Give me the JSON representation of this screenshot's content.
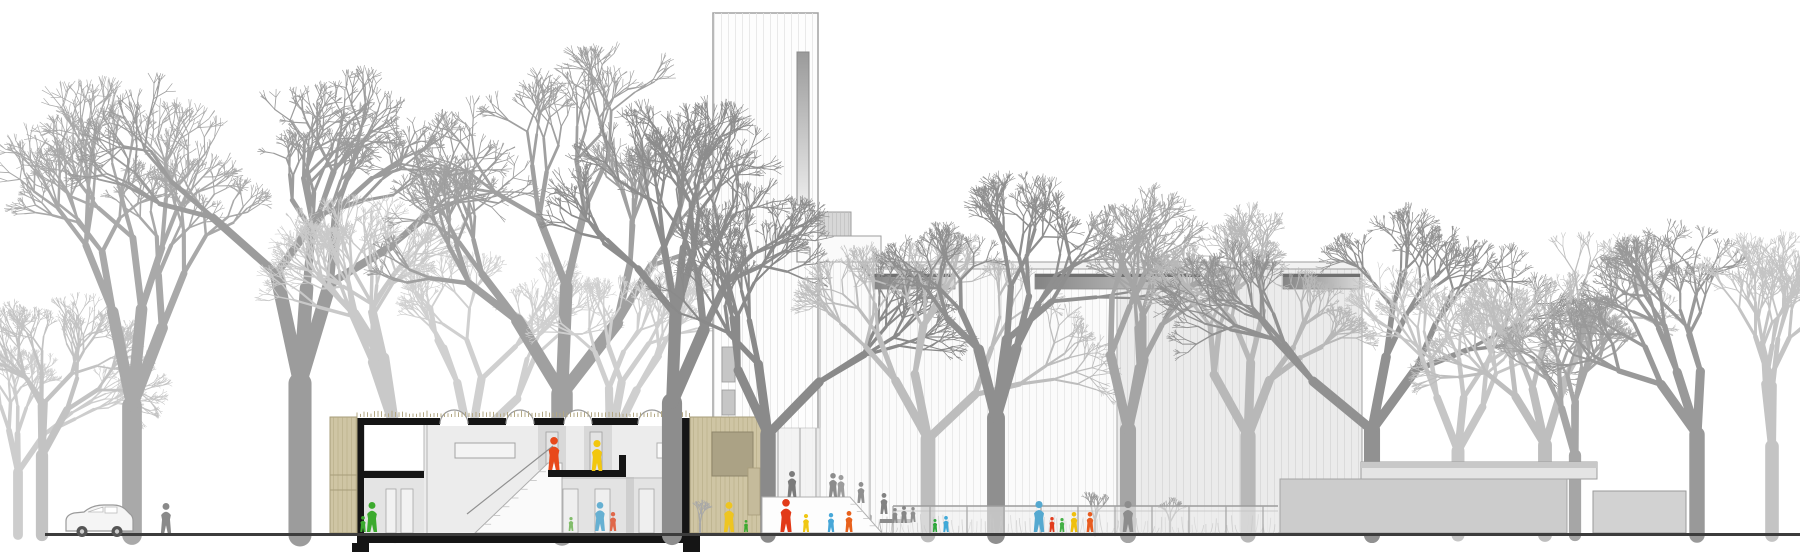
{
  "meta": {
    "drawing_type": "architectural-section-elevation",
    "subject": "church-ensemble-with-sectioned-community-building"
  },
  "scene": {
    "width": 1800,
    "height": 557,
    "background": "#ffffff",
    "ground": {
      "y": 533,
      "x_start": 45,
      "x_end": 1800,
      "color": "#3c3c3c",
      "thickness": 3
    }
  },
  "palette": {
    "section_black": "#151515",
    "interior_gray": "#ececec",
    "interior_light": "#e4e4e4",
    "wood": "#cfc5a4",
    "wood_stripe": "#b4a984",
    "wood_inset": "#aba285",
    "tower_fill": "#fdfdfd",
    "tower_stripe": "#e4e4e4",
    "tower_outline": "#a2a2a2",
    "nave_left_fill": "#fbfbfb",
    "nave_left_stripe": "#e7e7e7",
    "nave_right_fill": "#ebebeb",
    "nave_right_stripe": "#d9d9d9",
    "annex_roof_band": "#c8c8c8",
    "annex_roof_fill": "#e4e4e4",
    "annex_wall": "#cccccc",
    "annex_block": "#d2d2d2",
    "outline_gray": "#9e9e9e",
    "glass": "#f2f2f2",
    "fence_post": "#a5a5a5",
    "shrub": "#a3a3a3",
    "figure_orange": "#e8491b",
    "figure_red": "#e23a18",
    "figure_yellow": "#f2c70e",
    "figure_green": "#3caa2e",
    "figure_teal": "#5badd2",
    "figure_salmon": "#e0684a",
    "figure_gray": "#8a8a8a",
    "roof_fringe": "#b3a884",
    "car_body": "#f5f5f5",
    "car_outline": "#9a9a9a",
    "wheel": "#555555"
  },
  "trees": {
    "background": [
      {
        "x": 18,
        "height": 210,
        "color": "#cdcdcd",
        "seed": 11,
        "spread": 1.0
      },
      {
        "x": 42,
        "height": 265,
        "color": "#c3c3c3",
        "seed": 12,
        "spread": 1.05
      },
      {
        "x": 132,
        "height": 430,
        "color": "#a9a9a9",
        "seed": 13,
        "spread": 1.1
      },
      {
        "x": 300,
        "height": 505,
        "color": "#9c9c9c",
        "seed": 14,
        "spread": 1.3
      },
      {
        "x": 395,
        "height": 355,
        "color": "#c9c9c9",
        "seed": 15,
        "spread": 1.1
      },
      {
        "x": 470,
        "height": 305,
        "color": "#d0d0d0",
        "seed": 16,
        "spread": 1.0
      },
      {
        "x": 562,
        "height": 470,
        "color": "#a0a0a0",
        "seed": 17,
        "spread": 1.1
      },
      {
        "x": 610,
        "height": 300,
        "color": "#cfcfcf",
        "seed": 19,
        "spread": 1.0
      }
    ],
    "midground": [
      {
        "x": 672,
        "height": 440,
        "color": "#8d8d8d",
        "seed": 18,
        "spread": 1.1
      },
      {
        "x": 768,
        "height": 335,
        "color": "#8a8a8a",
        "seed": 21,
        "spread": 1.05
      },
      {
        "x": 928,
        "height": 320,
        "color": "#bdbdbd",
        "seed": 22,
        "spread": 1.1
      },
      {
        "x": 996,
        "height": 390,
        "color": "#8f8f8f",
        "seed": 23,
        "spread": 1.15
      },
      {
        "x": 1128,
        "height": 350,
        "color": "#a5a5a5",
        "seed": 24,
        "spread": 1.1
      },
      {
        "x": 1248,
        "height": 330,
        "color": "#b8b8b8",
        "seed": 25,
        "spread": 1.05
      },
      {
        "x": 1372,
        "height": 350,
        "color": "#919191",
        "seed": 26,
        "spread": 1.1
      },
      {
        "x": 1458,
        "height": 280,
        "color": "#c6c6c6",
        "seed": 27,
        "spread": 1.0
      },
      {
        "x": 1545,
        "height": 300,
        "color": "#bebebe",
        "seed": 28,
        "spread": 1.1
      },
      {
        "x": 1575,
        "height": 265,
        "color": "#a6a6a6",
        "seed": 29,
        "spread": 1.0
      },
      {
        "x": 1697,
        "height": 335,
        "color": "#999999",
        "seed": 30,
        "spread": 1.15
      },
      {
        "x": 1772,
        "height": 295,
        "color": "#c4c4c4",
        "seed": 31,
        "spread": 1.0
      }
    ],
    "saplings": [
      {
        "x": 1095,
        "height": 48,
        "color": "#9a9a9a",
        "seed": 41,
        "spread": 1.0
      },
      {
        "x": 1170,
        "height": 42,
        "color": "#a2a2a2",
        "seed": 42,
        "spread": 1.0
      },
      {
        "x": 700,
        "height": 38,
        "color": "#a8a8a8",
        "seed": 43,
        "spread": 1.0
      }
    ]
  },
  "section_building": {
    "wood_bay_left": {
      "x": 330,
      "y": 417,
      "w": 27,
      "h": 116,
      "panel_lines_y": [
        475,
        490
      ]
    },
    "left_wall": {
      "x": 357,
      "y": 418,
      "w": 7,
      "h": 115
    },
    "right_wall": {
      "x": 681,
      "y": 418,
      "w": 11,
      "h": 115
    },
    "roof_band": {
      "x": 357,
      "y": 418,
      "w": 335,
      "h": 7
    },
    "roof_fringe": {
      "x1": 357,
      "x2": 692,
      "y": 417
    },
    "arch_skylights": {
      "centers_x": [
        454,
        520,
        578,
        652
      ],
      "half_width": 14,
      "base_y": 424
    },
    "floor_slab": {
      "x": 357,
      "y": 533,
      "w": 343,
      "h": 10
    },
    "footings": [
      {
        "x": 352,
        "y": 543,
        "w": 17,
        "h": 9
      },
      {
        "x": 683,
        "y": 543,
        "w": 17,
        "h": 9
      }
    ],
    "interior": {
      "x": 364,
      "y": 424,
      "w": 317,
      "h": 109
    },
    "upper_left_room": {
      "x": 364,
      "y": 424,
      "w": 60,
      "h": 47
    },
    "interior_slab": {
      "x": 357,
      "y": 471,
      "w": 67,
      "h": 7
    },
    "lower_left_room": {
      "x": 364,
      "y": 478,
      "w": 60,
      "h": 55,
      "doors": [
        {
          "x": 386,
          "y": 489,
          "w": 10,
          "h": 44
        },
        {
          "x": 401,
          "y": 489,
          "w": 12,
          "h": 44
        }
      ]
    },
    "hall_wall_x": 427,
    "long_window": {
      "x": 455,
      "y": 443,
      "w": 60,
      "h": 15
    },
    "right_window": {
      "x": 657,
      "y": 443,
      "w": 23,
      "h": 15
    },
    "upper_partitions": [
      {
        "x": 538,
        "y": 424,
        "w": 28,
        "h": 46,
        "door": {
          "x": 546,
          "y": 432,
          "w": 12,
          "h": 38
        }
      },
      {
        "x": 584,
        "y": 424,
        "w": 28,
        "h": 49,
        "door": {
          "x": 590,
          "y": 432,
          "w": 12,
          "h": 41
        }
      }
    ],
    "lower_rooms": {
      "x": 548,
      "y": 477,
      "w": 133,
      "h": 56,
      "wall": {
        "x": 626,
        "y": 477,
        "w": 8,
        "h": 56
      },
      "doors": [
        {
          "x": 563,
          "y": 489,
          "w": 15,
          "h": 44
        },
        {
          "x": 595,
          "y": 489,
          "w": 15,
          "h": 44
        },
        {
          "x": 639,
          "y": 489,
          "w": 15,
          "h": 44
        }
      ]
    },
    "stair": {
      "poly": [
        [
          475,
          533
        ],
        [
          548,
          463
        ],
        [
          562,
          463
        ],
        [
          562,
          533
        ]
      ],
      "rail": [
        [
          467,
          514
        ],
        [
          553,
          446
        ]
      ],
      "steps": 8
    },
    "mezzanine": {
      "slab": {
        "x": 548,
        "y": 470,
        "w": 78,
        "h": 7
      },
      "upstand": {
        "x": 619,
        "y": 455,
        "w": 7,
        "h": 15
      }
    }
  },
  "wood_annex": {
    "x": 690,
    "y": 417,
    "w": 72,
    "h": 116,
    "inset_panel": {
      "x": 712,
      "y": 432,
      "w": 41,
      "h": 44
    },
    "side_strip": {
      "x": 748,
      "y": 468,
      "w": 12,
      "h": 47
    }
  },
  "tower": {
    "x": 713,
    "y": 13,
    "w": 105,
    "h": 492,
    "slot_window": {
      "x": 797,
      "y": 52,
      "w": 12,
      "h": 153
    },
    "small_square": {
      "x": 797,
      "y": 248,
      "w": 13,
      "h": 14
    },
    "louvers": [
      {
        "x": 722,
        "y": 347,
        "w": 13,
        "h": 35
      },
      {
        "x": 722,
        "y": 390,
        "w": 13,
        "h": 25
      }
    ]
  },
  "linking_volumes": {
    "gray_box": {
      "x": 818,
      "y": 212,
      "w": 33,
      "h": 24
    },
    "white_slab": {
      "x": 818,
      "y": 236,
      "w": 63,
      "h": 26
    }
  },
  "nave": {
    "x": 820,
    "y": 262,
    "w": 542,
    "bottom": 533,
    "parapet": {
      "x": 850,
      "y": 262,
      "w": 512,
      "h": 7
    },
    "joint_x": [
      870,
      1117
    ],
    "right_section_x": 1117,
    "clerestories": [
      {
        "x": 873,
        "y": 274,
        "w": 82,
        "h": 15
      },
      {
        "x": 1035,
        "y": 274,
        "w": 165,
        "h": 15
      },
      {
        "x": 1283,
        "y": 274,
        "w": 77,
        "h": 15
      }
    ]
  },
  "entrance": {
    "glass": {
      "x": 762,
      "y": 428,
      "w": 58,
      "h": 105
    },
    "mullions_x": [
      778,
      800,
      816
    ],
    "platform": {
      "poly": [
        [
          762,
          497
        ],
        [
          850,
          497
        ],
        [
          882,
          533
        ],
        [
          762,
          533
        ]
      ],
      "steps": 4
    },
    "bench": {
      "x": 880,
      "y": 519,
      "w": 32,
      "h": 4
    }
  },
  "fence": {
    "x_start": 893,
    "x_end": 1278,
    "rail_y": 506,
    "rail2_y": 511,
    "post_step": 37,
    "bottom": 533
  },
  "shrub_band": {
    "x_start": 765,
    "x_end": 1278,
    "base_y": 533
  },
  "parish_annex": {
    "roof_slab": {
      "x": 1361,
      "y": 462,
      "w": 236,
      "h": 17,
      "band_h": 6
    },
    "front_wall": {
      "x": 1280,
      "y": 479,
      "w": 287,
      "h": 54
    },
    "door_gap": {
      "x": 1567,
      "w": 26
    },
    "right_block": {
      "x": 1593,
      "y": 491,
      "w": 93,
      "h": 42
    }
  },
  "car": {
    "x": 65,
    "y_top": 505,
    "y_base": 533,
    "length": 68,
    "wheels_x": [
      82,
      117
    ],
    "wheel_r": 5.5
  },
  "figures": [
    {
      "x": 166,
      "base": 533,
      "h": 30,
      "color": "#8a8a8a",
      "group": "street"
    },
    {
      "x": 372,
      "base": 532,
      "h": 30,
      "color": "#3caa2e",
      "group": "section-interior"
    },
    {
      "x": 363,
      "base": 532,
      "h": 16,
      "color": "#3caa2e",
      "group": "section-interior"
    },
    {
      "x": 554,
      "base": 470,
      "h": 33,
      "color": "#e8491b",
      "group": "section-interior"
    },
    {
      "x": 597,
      "base": 471,
      "h": 31,
      "color": "#f2c70e",
      "group": "section-interior"
    },
    {
      "x": 600,
      "base": 531,
      "h": 29,
      "color": "#66b0d2",
      "group": "section-interior"
    },
    {
      "x": 571,
      "base": 531,
      "h": 14,
      "color": "#82bd6b",
      "group": "section-interior"
    },
    {
      "x": 613,
      "base": 531,
      "h": 19,
      "color": "#e0684a",
      "group": "section-interior"
    },
    {
      "x": 729,
      "base": 532,
      "h": 30,
      "color": "#eec520",
      "group": "plaza"
    },
    {
      "x": 746,
      "base": 532,
      "h": 12,
      "color": "#3caa2e",
      "group": "plaza"
    },
    {
      "x": 786,
      "base": 532,
      "h": 33,
      "color": "#e23a18",
      "group": "plaza"
    },
    {
      "x": 806,
      "base": 532,
      "h": 18,
      "color": "#f0c713",
      "group": "plaza"
    },
    {
      "x": 831,
      "base": 532,
      "h": 19,
      "color": "#47a7d8",
      "group": "plaza"
    },
    {
      "x": 849,
      "base": 532,
      "h": 21,
      "color": "#e8611c",
      "group": "plaza"
    },
    {
      "x": 935,
      "base": 532,
      "h": 13,
      "color": "#2fa83c",
      "group": "plaza"
    },
    {
      "x": 946,
      "base": 532,
      "h": 16,
      "color": "#3fa9d8",
      "group": "plaza"
    },
    {
      "x": 1039,
      "base": 532,
      "h": 31,
      "color": "#55a9d0",
      "group": "plaza"
    },
    {
      "x": 1052,
      "base": 532,
      "h": 15,
      "color": "#e23c1e",
      "group": "plaza"
    },
    {
      "x": 1062,
      "base": 532,
      "h": 14,
      "color": "#43b045",
      "group": "plaza"
    },
    {
      "x": 1074,
      "base": 532,
      "h": 20,
      "color": "#efc00e",
      "group": "plaza"
    },
    {
      "x": 1090,
      "base": 532,
      "h": 20,
      "color": "#e85c20",
      "group": "plaza"
    },
    {
      "x": 1128,
      "base": 532,
      "h": 31,
      "color": "#8d8d8d",
      "group": "plaza"
    },
    {
      "x": 792,
      "base": 497,
      "h": 26,
      "color": "#7b7b7b",
      "group": "platform"
    },
    {
      "x": 833,
      "base": 497,
      "h": 24,
      "color": "#8c8c8c",
      "group": "platform"
    },
    {
      "x": 841,
      "base": 497,
      "h": 22,
      "color": "#9c9c9c",
      "group": "platform"
    },
    {
      "x": 861,
      "base": 503,
      "h": 21,
      "color": "#8f8f8f",
      "group": "platform"
    },
    {
      "x": 884,
      "base": 514,
      "h": 21,
      "color": "#828282",
      "group": "platform"
    },
    {
      "x": 895,
      "base": 523,
      "h": 15,
      "color": "#8a8a8a",
      "group": "platform"
    },
    {
      "x": 904,
      "base": 523,
      "h": 17,
      "color": "#858585",
      "group": "platform"
    },
    {
      "x": 913,
      "base": 522,
      "h": 15,
      "color": "#8f8f8f",
      "group": "platform"
    }
  ]
}
